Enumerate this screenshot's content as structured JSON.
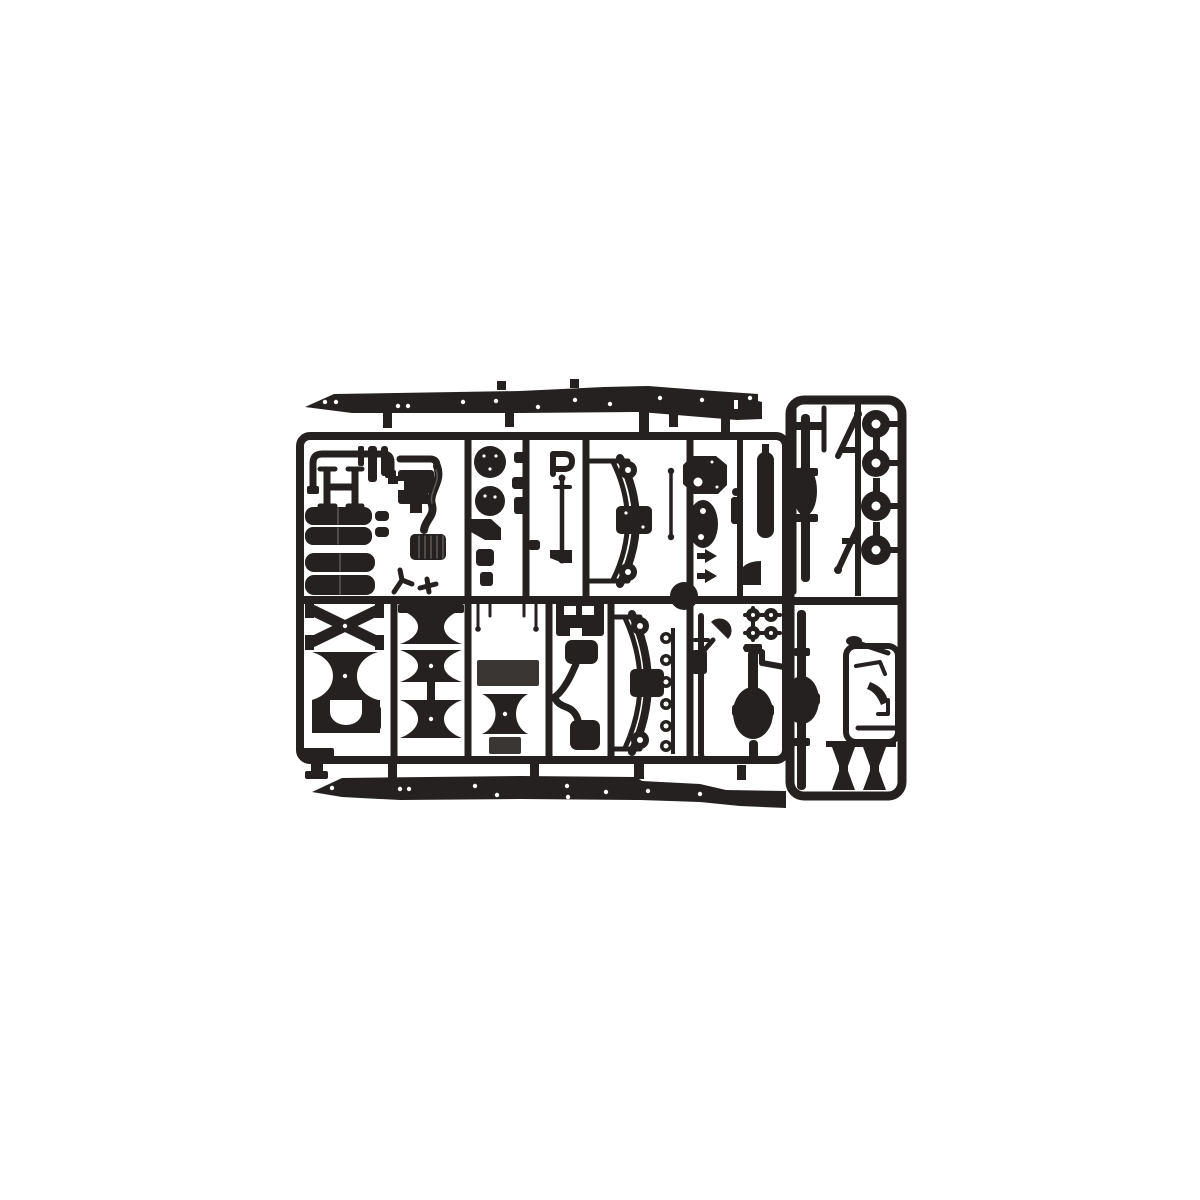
{
  "meta": {
    "description": "Product photograph of a single injection-molded sprue of black polystyrene scale-model truck chassis parts on a plain white background",
    "subject": "model kit parts sprue",
    "plastic_color_name": "black",
    "background_color_name": "white"
  },
  "colors": {
    "background": "#ffffff",
    "plastic": "#242120",
    "deep": "#171514",
    "plate": "#3a3634",
    "highlight": "#5e5955",
    "hole": "#fdfdfc"
  },
  "sprue": {
    "layout": "two long chassis frame rails at top and bottom, a rectangular runner grid of parts cells in the middle, and a separate tall runner frame on the right holding wheels and axles",
    "parts_inventory": [
      {
        "name": "chassis frame rail",
        "count": 2
      },
      {
        "name": "wheel / brake drum disc",
        "count": 4
      },
      {
        "name": "leaf spring assembly with shackles",
        "count": 2
      },
      {
        "name": "fuel tank cylinder",
        "count": 4
      },
      {
        "name": "round air reservoir tank",
        "count": 2
      },
      {
        "name": "rear axle housing",
        "count": 2
      },
      {
        "name": "front axle shaft with differential bulge",
        "count": 1
      },
      {
        "name": "differential cover plate",
        "count": 1
      },
      {
        "name": "oval access plate",
        "count": 1
      },
      {
        "name": "X-type crossmember",
        "count": 1
      },
      {
        "name": "waisted spool crossmember",
        "count": 5
      },
      {
        "name": "flat chassis mounting plate",
        "count": 2
      },
      {
        "name": "muffler canister with elbow pipe",
        "count": 2
      },
      {
        "name": "S-curved exhaust pipe",
        "count": 1
      },
      {
        "name": "engine mount block",
        "count": 1
      },
      {
        "name": "ribbed bellows section",
        "count": 1
      },
      {
        "name": "sealing ring",
        "count": 6
      },
      {
        "name": "small hub disc",
        "count": 4
      },
      {
        "name": "tie rod / linkage rod",
        "count": 6
      },
      {
        "name": "diagonal torque rod",
        "count": 2
      },
      {
        "name": "spring hanger wedge",
        "count": 2
      },
      {
        "name": "saddle bracket",
        "count": 1
      },
      {
        "name": "assorted small brackets and levers",
        "count": 14
      }
    ]
  }
}
